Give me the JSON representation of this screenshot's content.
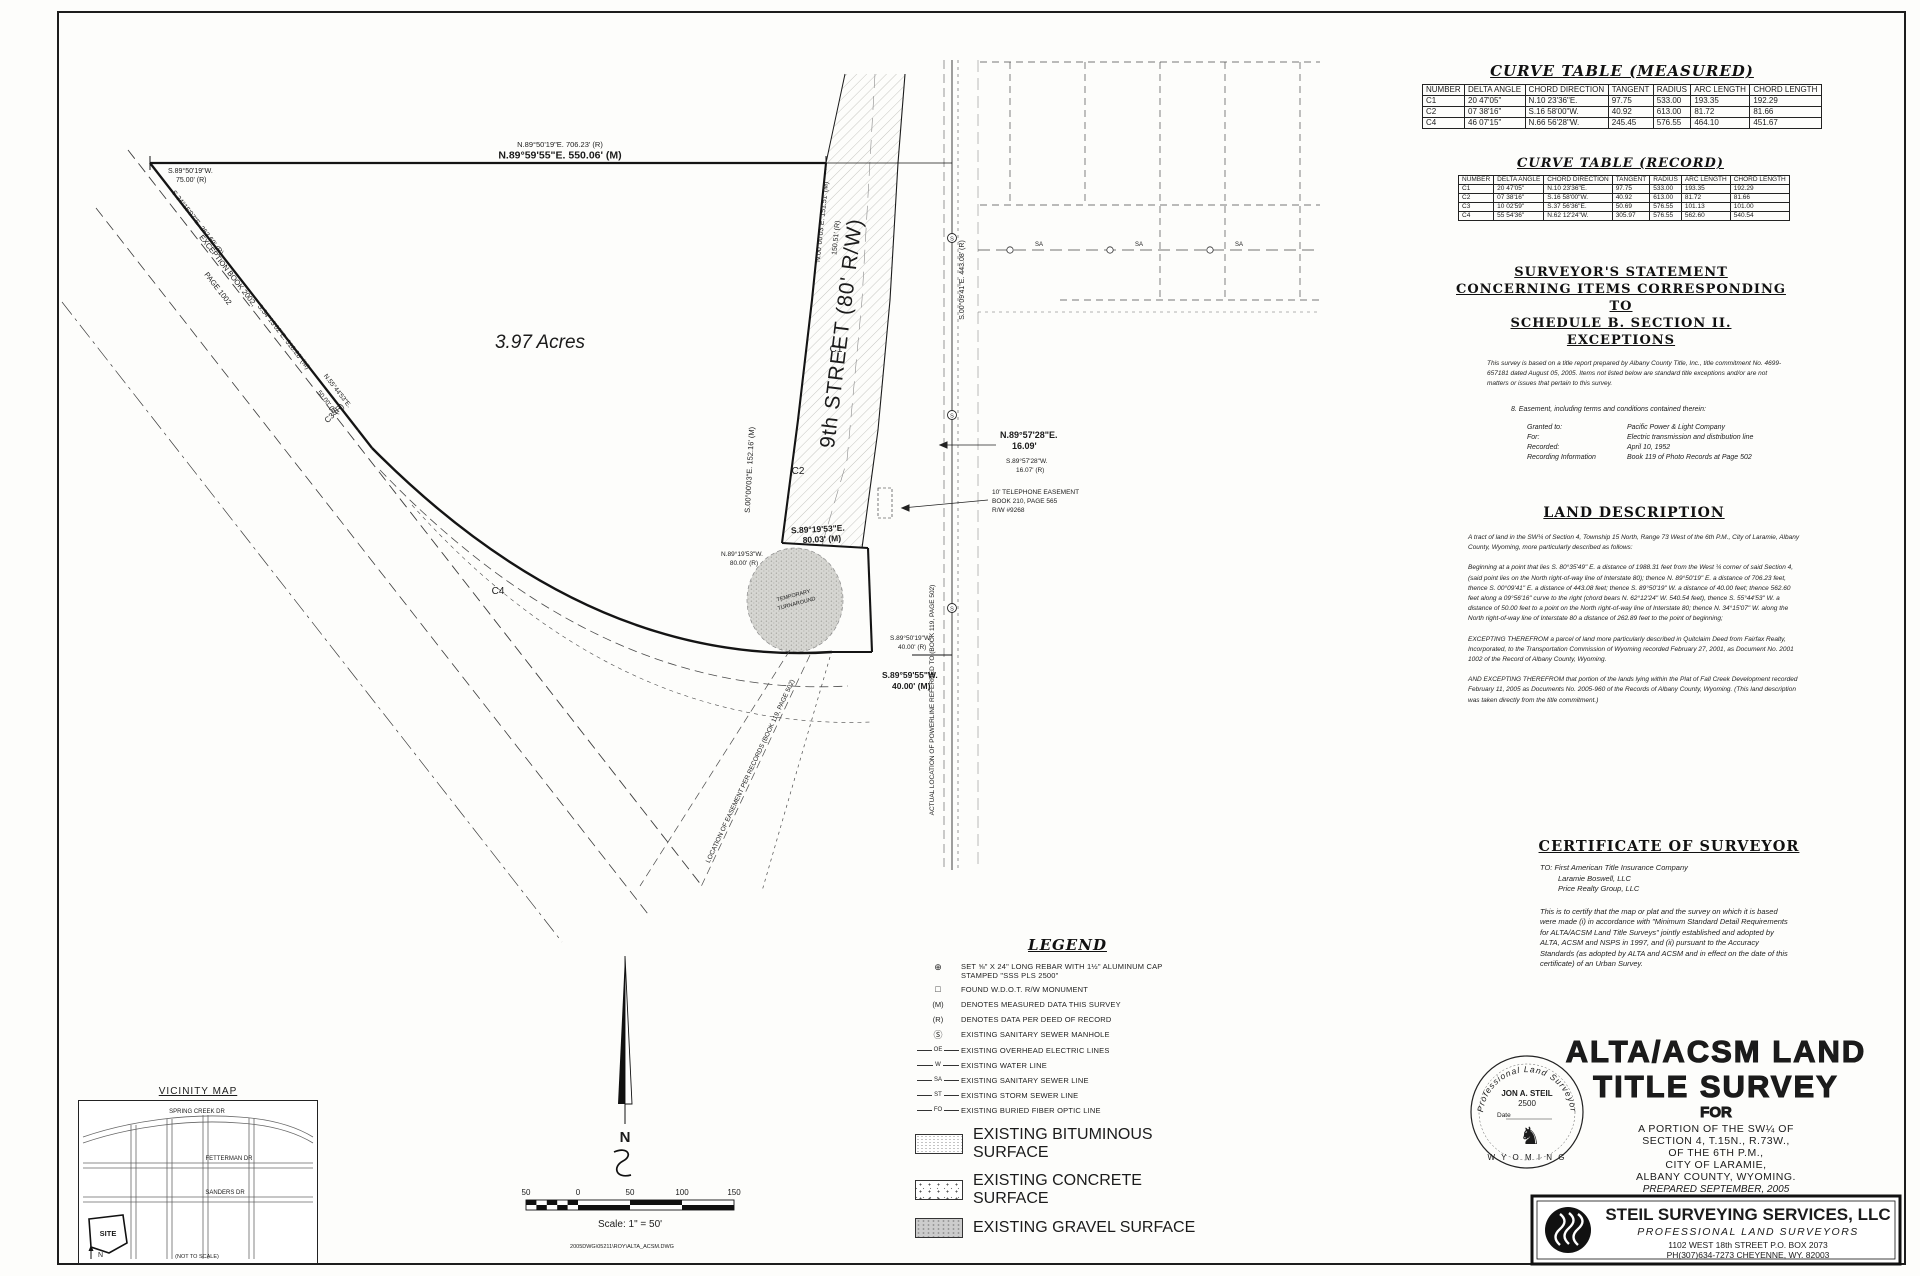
{
  "sheet": {
    "file_note": "2005DWG\\05211\\ROY\\ALTA_ACSM.DWG"
  },
  "curve_measured": {
    "title": "CURVE TABLE (MEASURED)",
    "headers": [
      "NUMBER",
      "DELTA ANGLE",
      "CHORD DIRECTION",
      "TANGENT",
      "RADIUS",
      "ARC LENGTH",
      "CHORD LENGTH"
    ],
    "rows": [
      [
        "C1",
        "20 47'05\"",
        "N.10 23'36\"E.",
        "97.75",
        "533.00",
        "193.35",
        "192.29"
      ],
      [
        "C2",
        "07 38'16\"",
        "S.16 58'00\"W.",
        "40.92",
        "613.00",
        "81.72",
        "81.66"
      ],
      [
        "C4",
        "46 07'15\"",
        "N.66 56'28\"W.",
        "245.45",
        "576.55",
        "464.10",
        "451.67"
      ]
    ]
  },
  "curve_record": {
    "title": "CURVE TABLE (RECORD)",
    "headers": [
      "NUMBER",
      "DELTA ANGLE",
      "CHORD DIRECTION",
      "TANGENT",
      "RADIUS",
      "ARC LENGTH",
      "CHORD LENGTH"
    ],
    "rows": [
      [
        "C1",
        "20 47'05\"",
        "N.10 23'36\"E.",
        "97.75",
        "533.00",
        "193.35",
        "192.29"
      ],
      [
        "C2",
        "07 38'16\"",
        "S.16 58'00\"W.",
        "40.92",
        "613.00",
        "81.72",
        "81.66"
      ],
      [
        "C3",
        "10 02'59\"",
        "S.37 56'36\"E.",
        "50.69",
        "576.55",
        "101.13",
        "101.00"
      ],
      [
        "C4",
        "55 54'36\"",
        "N.62 12'24\"W.",
        "305.97",
        "576.55",
        "562.60",
        "540.54"
      ]
    ]
  },
  "statement": {
    "title1": "SURVEYOR'S STATEMENT",
    "title2": "CONCERNING ITEMS CORRESPONDING TO",
    "title3": "SCHEDULE B. SECTION II. EXCEPTIONS",
    "intro": "This survey is based on a title report prepared by Albany County Title, Inc.,  title commitment No. 4699-657181 dated August 05, 2005. Items not listed below are standard title exceptions and/or are not matters or issues that pertain to this survey.",
    "item": "8.  Easement, including terms and conditions contained therein:",
    "rows": [
      {
        "label": "Granted to:",
        "value": "Pacific Power & Light Company"
      },
      {
        "label": "For:",
        "value": "Electric transmission and distribution line"
      },
      {
        "label": "Recorded:",
        "value": "April 10, 1952"
      },
      {
        "label": "Recording Information",
        "value": "Book 119 of Photo Records at  Page 502"
      }
    ]
  },
  "land_description": {
    "title": "LAND DESCRIPTION",
    "p1": "A tract of land in the SW¼ of Section 4, Township 15 North, Range 73 West of the 6th P.M., City of Laramie, Albany County, Wyoming, more particularly described as follows:",
    "p2": "Beginning at a point that lies S. 80°35'49\" E. a distance of 1988.31 feet from the West ¼ corner of said Section 4, (said point lies on the North right-of-way line of Interstate 80); thence N. 89°50'19\" E. a distance of 706.23 feet, thence S. 00°09'41\" E. a distance of 443.08 feet; thence S. 89°50'19\" W. a distance of 40.00 feet; thence 562.60 feet along a 09°56'16\" curve to the right (chord bears N. 62°12'24\" W. 540.54 feet), thence S. 55°44'53\" W. a distance of 50.00 feet to a point on the North right-of-way line of Interstate 80; thence N. 34°15'07\" W. along the North right-of-way line of Interstate 80 a distance of 262.89 feet to the point of beginning;",
    "p3": "EXCEPTING THEREFROM a parcel of land more particularly described in Quitclaim Deed from Fairfax Realty, Incorporated, to the Transportation Commission of Wyoming recorded February 27, 2001, as Document No. 2001 1002 of the Record of Albany County, Wyoming.",
    "p4": "AND EXCEPTING THEREFROM that portion of the lands lying within the Plat of Fall Creek Development recorded February 11, 2005 as Documents No. 2005-960 of the Records of Albany County, Wyoming. (This land description was taken directly from the title commitment.)"
  },
  "certificate": {
    "title": "CERTIFICATE OF SURVEYOR",
    "to1": "TO:  First American Title Insurance Company",
    "to2": "Laramie Boswell, LLC",
    "to3": "Price Realty Group, LLC",
    "body": "This is to certify that the map or plat and the survey on which it is based were made (i) in accordance with \"Minimum Standard Detail Requirements for ALTA/ACSM Land Title Surveys\" jointly established and adopted by ALTA, ACSM and NSPS in 1997, and (ii) pursuant to the Accuracy Standards (as adopted by ALTA and ACSM and in effect on the date of this certificate) of an Urban Survey."
  },
  "title_block": {
    "line1": "ALTA/ACSM LAND",
    "line2": "TITLE SURVEY",
    "for_word": "FOR",
    "loc1": "A PORTION OF THE SW¼ OF",
    "loc2": "SECTION 4, T.15N., R.73W.,",
    "loc3": "OF THE 6TH P.M.,",
    "loc4": "CITY OF LARAMIE,",
    "loc5": "ALBANY COUNTY, WYOMING.",
    "prepared": "PREPARED SEPTEMBER, 2005"
  },
  "firm": {
    "name": "STEIL SURVEYING SERVICES, LLC",
    "tagline": "PROFESSIONAL LAND SURVEYORS",
    "address": "1102 WEST 18th STREET   P.O. BOX 2073",
    "phone": "PH(307)634-7273  CHEYENNE, WY.  82003"
  },
  "seal": {
    "arc": "Professional Land Surveyor",
    "name": "JON A. STEIL",
    "number": "2500",
    "date_label": "Date",
    "state": "W Y O M I N G",
    "horse": "♞"
  },
  "legend": {
    "title": "LEGEND",
    "sym_rebar": "⊕",
    "sym_monument": "□",
    "sym_m": "(M)",
    "sym_r": "(R)",
    "sym_manhole": "Ⓢ",
    "tag_oe": "OE",
    "tag_w": "W",
    "tag_sa": "SA",
    "tag_st": "ST",
    "tag_fo": "FO",
    "i1": "SET ⅝\" X 24\" LONG REBAR WITH 1½\" ALUMINUM CAP STAMPED \"SSS PLS 2500\"",
    "i2": "FOUND W.D.O.T. R/W MONUMENT",
    "i3": "DENOTES MEASURED DATA THIS SURVEY",
    "i4": "DENOTES DATA PER DEED OF RECORD",
    "i5": "EXISTING SANITARY SEWER MANHOLE",
    "i6": "EXISTING OVERHEAD ELECTRIC LINES",
    "i7": "EXISTING WATER LINE",
    "i8": "EXISTING SANITARY SEWER LINE",
    "i9": "EXISTING STORM SEWER LINE",
    "i10": "EXISTING BURIED FIBER OPTIC LINE",
    "i11": "EXISTING BITUMINOUS SURFACE",
    "i12": "EXISTING CONCRETE SURFACE",
    "i13": "EXISTING GRAVEL SURFACE"
  },
  "scalebar": {
    "t1": "50",
    "t2": "0",
    "t3": "50",
    "t4": "100",
    "t5": "150",
    "caption": "Scale: 1\" = 50'"
  },
  "north": {
    "label": "N"
  },
  "vicinity": {
    "title": "VICINITY MAP",
    "s1": "SPRING CREEK DR",
    "s2": "FETTERMAN DR",
    "s3": "SANDERS DR",
    "site": "SITE",
    "note": "(NOT TO SCALE)",
    "north": "N"
  },
  "plat": {
    "top_r": "N.89°50'19\"E. 706.23' (R)",
    "top_m": "N.89°59'55\"E.  550.06' (M)",
    "nw1": "S.89°50'19\"W.",
    "nw2": "75.00' (R)",
    "exc1": "EXCEPTION BOOK 2002,",
    "exc2": "PAGE 1002",
    "hwy_r": "S.34°15'07\"E. 263.69' (R)",
    "hwy_m": "S.34°13'02\"E. 318.28' (M)",
    "jog1": "N.55°44'53\"E.",
    "jog2": "50.00' (M)",
    "acres": "3.97 Acres",
    "street": "9th STREET (80' R/W)",
    "st_e_m": "N.00°00'03\"E. 151.51' (M)",
    "st_e_r": "150.51' (R)",
    "east_r": "S.00°09'41\"E. 443.08' (R)",
    "mid_m1": "N.89°57'28\"E.",
    "mid_m2": "16.09'",
    "mid_r1": "S.89°57'28\"W.",
    "mid_r2": "16.07' (R)",
    "tel1": "10' TELEPHONE EASEMENT",
    "tel2": "BOOK 210, PAGE 565",
    "tel3": "R/W #9268",
    "stub_m1": "S.89°19'53\"E.",
    "stub_m2": "80.03' (M)",
    "stub_r1": "N.89°19'53\"W.",
    "stub_r2": "80.00' (R)",
    "stub_e": "S.00°00'03\"E. 152.16' (M)",
    "bot_r1": "S.89°50'19\"W.",
    "bot_r2": "40.00' (R)",
    "bot_m1": "S.89°59'55\"W.",
    "bot_m2": "40.00' (M)",
    "ta1": "TEMPORARY",
    "ta2": "TURNAROUND",
    "loc_ease": "LOCATION OF EASEMENT PER RECORDS (BOOK 119, PAGE 502)",
    "loc_power": "ACTUAL LOCATION OF POWERLINE REFERRED TO (BOOK 119, PAGE 502)",
    "c1": "C1",
    "c2": "C2",
    "c3": "C3 (R)",
    "c4": "C4",
    "sa": "SA",
    "mh": "S"
  }
}
